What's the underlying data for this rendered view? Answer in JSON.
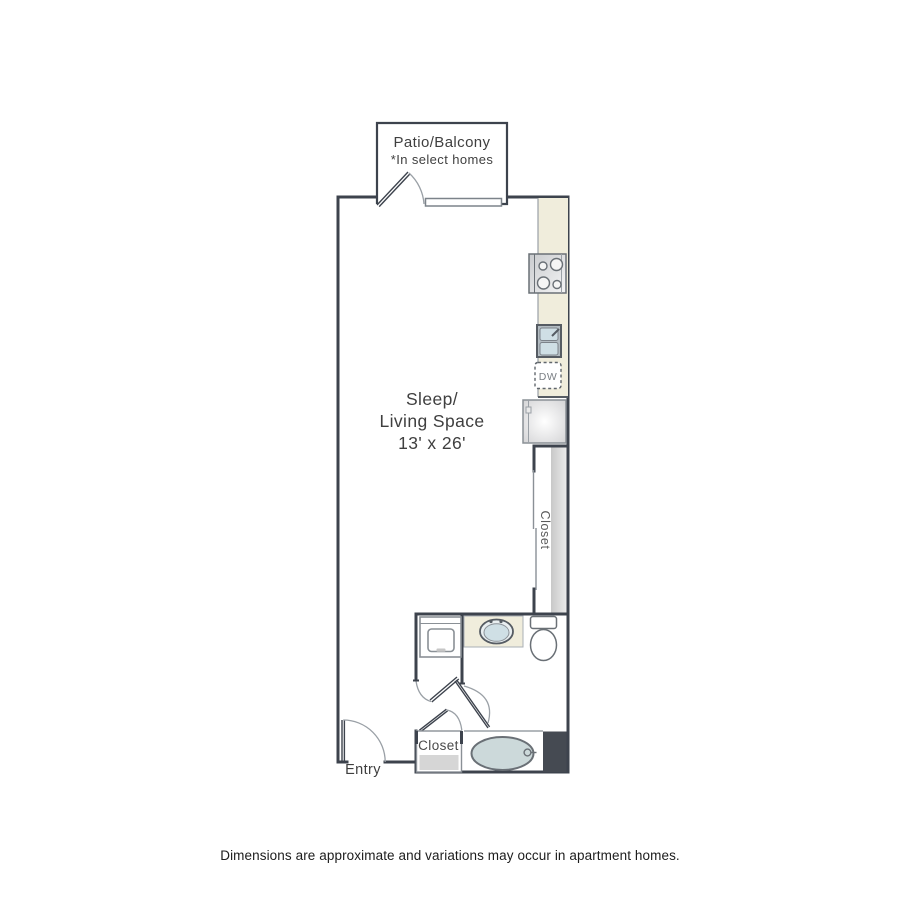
{
  "plan": {
    "patio": {
      "title": "Patio/Balcony",
      "note": "*In select homes"
    },
    "living": {
      "line1": "Sleep/",
      "line2": "Living Space",
      "dims": "13' x 26'"
    },
    "kitchen": {
      "dishwasher_label": "DW"
    },
    "closet_right_label": "Closet",
    "closet_entry_label": "Closet",
    "entry_label": "Entry"
  },
  "footer": {
    "disclaimer": "Dimensions are approximate and variations may occur in apartment homes."
  },
  "colors": {
    "wall": "#3d434d",
    "counter": "#f0eddc",
    "fixture_blue": "#cfdfe5",
    "tub_fill": "#ccd9da",
    "accent_block": "#454a52",
    "door_arc": "#9aa0a6",
    "closet_strip": "#d6d6d6",
    "text": "#3f3f3f"
  }
}
